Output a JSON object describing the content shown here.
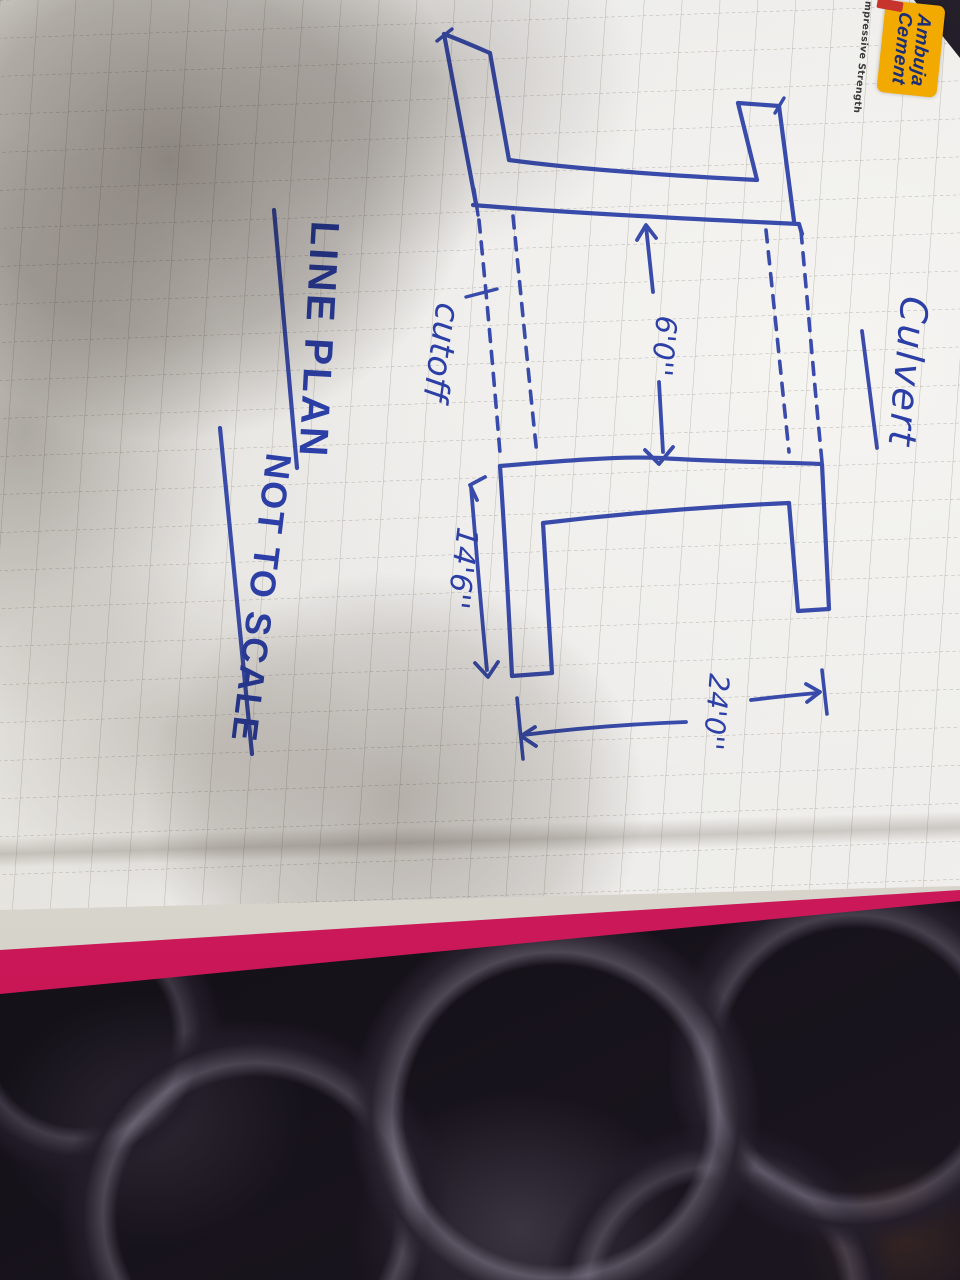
{
  "notebook": {
    "brand": {
      "line1": "Ambuja",
      "line2": "Cement",
      "tagline": "Compressive Strength"
    },
    "page": {
      "title": "Culvert",
      "caption_line1": "LINE PLAN",
      "caption_line2": "NOT TO SCALE",
      "labels": {
        "cutoff": "cutoff"
      },
      "dimensions": {
        "span": "6'0''",
        "wing_length": "14'6''",
        "overall": "24'0''"
      }
    }
  },
  "colors": {
    "ink": "#2c3fa6",
    "paper": "#edeceb",
    "grid_line": "#7d7664",
    "cover_pink": "#d81b60",
    "logo_bg": "#f2a900",
    "logo_text": "#1b2e77",
    "logo_accent": "#c7342e",
    "fabric_dark": "#16121a"
  }
}
